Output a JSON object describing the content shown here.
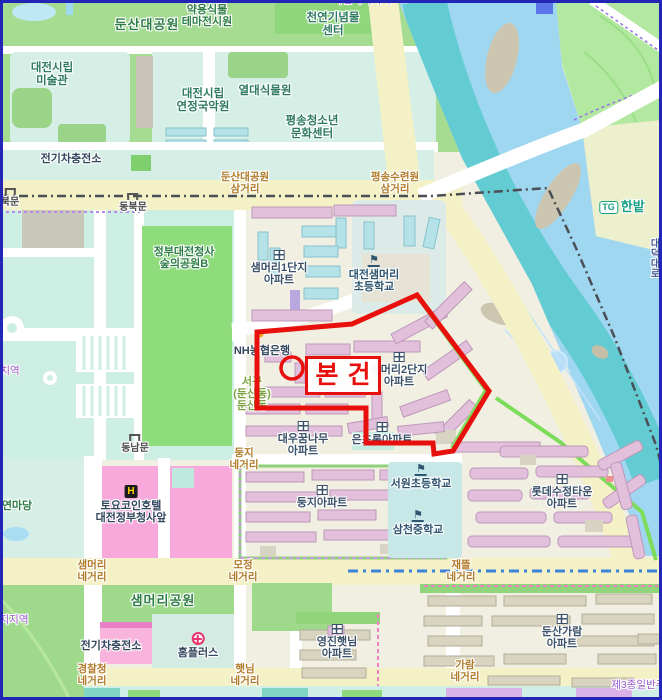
{
  "overlay": {
    "label": "본건",
    "accent_color": "#e8100c"
  },
  "map": {
    "colors": {
      "water": "#9fd6f0",
      "river_channel": "#63ccd3",
      "park_green": "#a5dc92",
      "major_road": "#f5f1c6",
      "building_pink": "#e2c0dc",
      "building_cyan": "#b5e2e8",
      "overlay_red": "#e8100c",
      "commercial_pink": "#f8a9db",
      "institution_teal": "#d6efe6"
    },
    "labels": [
      {
        "n": "dunsan-daegongwon",
        "c": "park-lg",
        "x": 147,
        "y": 18,
        "t": [
          "둔산대공원"
        ]
      },
      {
        "n": "yakyong-sikmul",
        "c": "park",
        "x": 207,
        "y": 4,
        "t": [
          "약용식물",
          "테마전시원"
        ]
      },
      {
        "n": "cheonyeon-ginyeommul",
        "c": "inst",
        "x": 333,
        "y": 12,
        "t": [
          "천연기념물",
          "센터"
        ]
      },
      {
        "n": "jayeon-nokji-zone",
        "c": "zone",
        "x": 362,
        "y": -5,
        "t": [
          "자연녹지지역"
        ]
      },
      {
        "n": "daejeon-museum",
        "c": "inst",
        "x": 52,
        "y": 62,
        "t": [
          "대전시립",
          "미술관"
        ]
      },
      {
        "n": "yeonjeong-gugagwon",
        "c": "inst",
        "x": 203,
        "y": 88,
        "t": [
          "대전시립",
          "연정국악원"
        ]
      },
      {
        "n": "yeoldae-sikmulwon",
        "c": "inst",
        "x": 265,
        "y": 85,
        "t": [
          "열대식물원"
        ]
      },
      {
        "n": "pyeongsong-center",
        "c": "inst",
        "x": 312,
        "y": 115,
        "t": [
          "평송청소년",
          "문화센터"
        ]
      },
      {
        "n": "ev-station-top",
        "c": "poi",
        "x": 71,
        "y": 153,
        "t": [
          "전기차충전소"
        ]
      },
      {
        "n": "dunsan-samgeori",
        "c": "junction",
        "x": 245,
        "y": 172,
        "t": [
          "둔산대공원",
          "삼거리"
        ]
      },
      {
        "n": "pyeongsong-samgeori",
        "c": "junction",
        "x": 395,
        "y": 172,
        "t": [
          "평송수련원",
          "삼거리"
        ]
      },
      {
        "n": "tg-hanbat",
        "c": "tg",
        "x": 622,
        "y": 200,
        "t": [
          "한밭"
        ],
        "badge": "TG"
      },
      {
        "n": "bukmun-gate",
        "c": "gate",
        "x": 10,
        "y": 188,
        "t": [
          "북문"
        ],
        "icon": "gate"
      },
      {
        "n": "dongbukmun-gate",
        "c": "gate",
        "x": 133,
        "y": 193,
        "t": [
          "동북문"
        ],
        "icon": "gate"
      },
      {
        "n": "gov-forest-park",
        "c": "park",
        "x": 184,
        "y": 246,
        "t": [
          "정부대전청사",
          "숲의공원B"
        ]
      },
      {
        "n": "saemmeori-1danji",
        "c": "apt",
        "x": 279,
        "y": 250,
        "t": [
          "샘머리1단지",
          "아파트"
        ],
        "icon": "apt"
      },
      {
        "n": "saemmeori-elementary",
        "c": "school",
        "x": 374,
        "y": 255,
        "t": [
          "대전샘머리",
          "초등학교"
        ],
        "icon": "school"
      },
      {
        "n": "nh-bank",
        "c": "poi",
        "x": 262,
        "y": 345,
        "t": [
          "NH농협은행"
        ]
      },
      {
        "n": "saemmeori-2danji",
        "c": "apt",
        "x": 399,
        "y": 352,
        "t": [
          "샘머리2단지",
          "아파트"
        ],
        "icon": "apt"
      },
      {
        "n": "seogu-dunsandong",
        "c": "district",
        "x": 252,
        "y": 376,
        "t": [
          "서구",
          "(둔산동)",
          "둔산동"
        ]
      },
      {
        "n": "daewoo-kkumnamu",
        "c": "apt",
        "x": 303,
        "y": 421,
        "t": [
          "대우꿈나무",
          "아파트"
        ],
        "icon": "apt"
      },
      {
        "n": "eunchorong",
        "c": "apt",
        "x": 382,
        "y": 422,
        "t": [
          "은초롱아파트"
        ],
        "icon": "apt"
      },
      {
        "n": "dungji-junction",
        "c": "junction",
        "x": 244,
        "y": 448,
        "t": [
          "둥지",
          "네거리"
        ]
      },
      {
        "n": "dongnammun-gate",
        "c": "gate",
        "x": 135,
        "y": 434,
        "t": [
          "동남문"
        ],
        "icon": "gate"
      },
      {
        "n": "seowon-elementary",
        "c": "school",
        "x": 421,
        "y": 464,
        "t": [
          "서원초등학교"
        ],
        "icon": "school"
      },
      {
        "n": "samcheon-middle",
        "c": "school",
        "x": 418,
        "y": 510,
        "t": [
          "삼천중학교"
        ],
        "icon": "school"
      },
      {
        "n": "dungji-apt",
        "c": "apt",
        "x": 322,
        "y": 485,
        "t": [
          "둥지아파트"
        ],
        "icon": "apt"
      },
      {
        "n": "mojeong-junction",
        "c": "junction",
        "x": 243,
        "y": 560,
        "t": [
          "모정",
          "네거리"
        ]
      },
      {
        "n": "jaetteul-junction",
        "c": "junction",
        "x": 461,
        "y": 560,
        "t": [
          "재뜰",
          "네거리"
        ]
      },
      {
        "n": "lotte-sujeong",
        "c": "apt",
        "x": 562,
        "y": 474,
        "t": [
          "롯데수정타운",
          "아파트"
        ],
        "icon": "apt"
      },
      {
        "n": "saemmeori-junction",
        "c": "junction",
        "x": 92,
        "y": 560,
        "t": [
          "샘머리",
          "네거리"
        ]
      },
      {
        "n": "saemmeori-park",
        "c": "park-lg",
        "x": 163,
        "y": 594,
        "t": [
          "샘머리공원"
        ]
      },
      {
        "n": "ev-station-bottom",
        "c": "poi",
        "x": 111,
        "y": 640,
        "t": [
          "전기차충전소"
        ]
      },
      {
        "n": "homeplus",
        "c": "poi",
        "x": 198,
        "y": 632,
        "t": [
          "홈플러스"
        ],
        "icon": "homeplus"
      },
      {
        "n": "gyeongchalcheong-junction",
        "c": "junction",
        "x": 92,
        "y": 664,
        "t": [
          "경찰청",
          "네거리"
        ]
      },
      {
        "n": "haennim-junction",
        "c": "junction",
        "x": 245,
        "y": 664,
        "t": [
          "햇님",
          "네거리"
        ]
      },
      {
        "n": "yeongjin-haennim",
        "c": "apt",
        "x": 337,
        "y": 624,
        "t": [
          "영진햇님",
          "아파트"
        ],
        "icon": "apt"
      },
      {
        "n": "dunsan-garam",
        "c": "apt",
        "x": 562,
        "y": 614,
        "t": [
          "둔산가람",
          "아파트"
        ],
        "icon": "apt"
      },
      {
        "n": "garam-junction",
        "c": "junction",
        "x": 465,
        "y": 660,
        "t": [
          "가람",
          "네거리"
        ]
      },
      {
        "n": "jong3-residential-zone",
        "c": "zone",
        "x": 648,
        "y": 680,
        "t": [
          "제3종일반주거지"
        ]
      },
      {
        "n": "yeonmadang",
        "c": "park",
        "x": 17,
        "y": 500,
        "t": [
          "연마당"
        ]
      },
      {
        "n": "toyoko-inn",
        "c": "poi",
        "x": 131,
        "y": 485,
        "t": [
          "토요코인호텔",
          "대전정부청사앞"
        ],
        "icon": "hotel",
        "iconText": "H"
      },
      {
        "n": "partial-zone-left",
        "c": "zone",
        "x": 10,
        "y": 366,
        "t": [
          "치역"
        ]
      },
      {
        "n": "partial-zone-left2",
        "c": "zone",
        "x": 14,
        "y": 615,
        "t": [
          "지지역"
        ]
      },
      {
        "n": "daedeok-daero-road",
        "c": "road-vert",
        "x": 648,
        "y": 238,
        "t": [
          "대덕대로"
        ],
        "vert": true
      }
    ]
  }
}
